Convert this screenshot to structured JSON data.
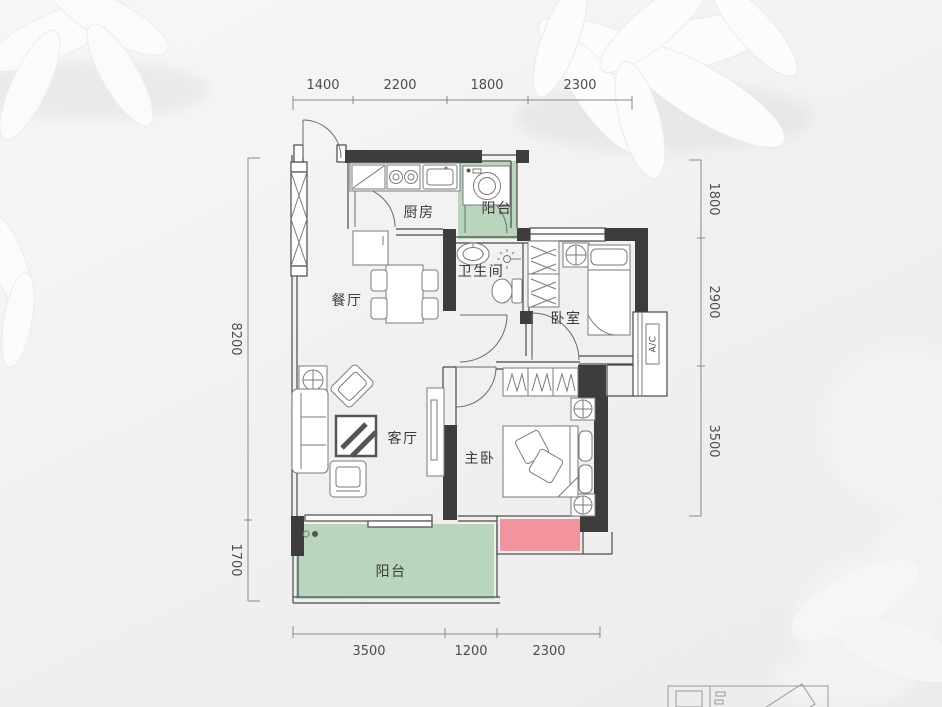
{
  "floorplan": {
    "room_labels": {
      "kitchen": "厨房",
      "balcony_top": "阳台",
      "bathroom": "卫生间",
      "bedroom": "卧室",
      "dining": "餐厅",
      "living": "客厅",
      "master_bedroom": "主卧",
      "balcony_bottom": "阳台"
    },
    "ac_label": "A/C",
    "dimensions": {
      "top": [
        "1400",
        "2200",
        "1800",
        "2300"
      ],
      "right": [
        "1800",
        "2900",
        "3500"
      ],
      "left": [
        "8200",
        "1700"
      ],
      "bottom": [
        "3500",
        "1200",
        "2300"
      ]
    },
    "colors": {
      "balcony_green": "#b9d6bd",
      "bay_window_pink": "#f2939d",
      "wall_dark": "#3d3d3d"
    }
  }
}
